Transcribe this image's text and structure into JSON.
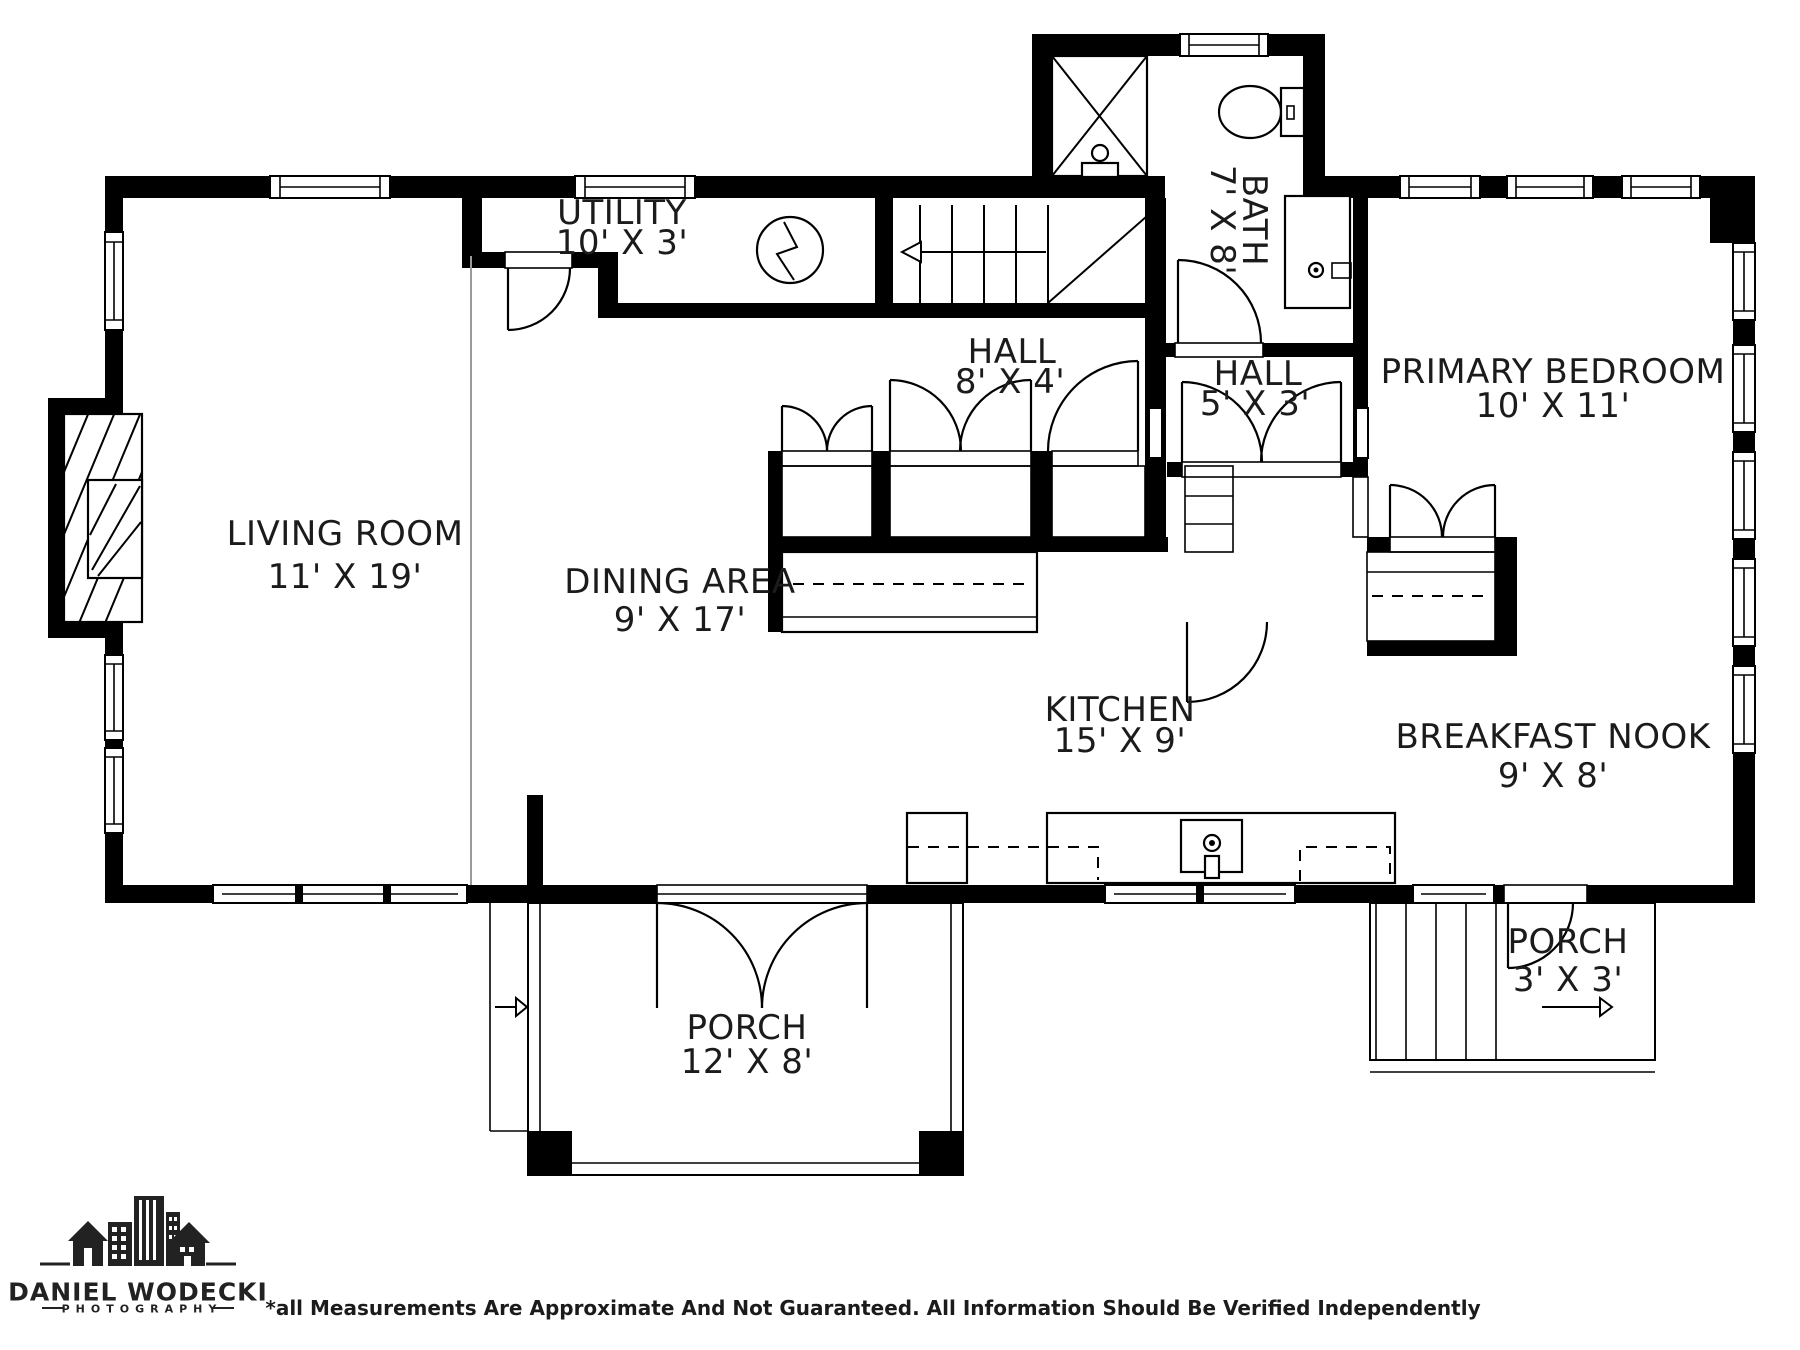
{
  "plan": {
    "rooms": [
      {
        "id": "living-room",
        "name": "LIVING ROOM",
        "dims": "11' X 19'"
      },
      {
        "id": "dining-area",
        "name": "DINING AREA",
        "dims": "9' X 17'"
      },
      {
        "id": "utility",
        "name": "UTILITY",
        "dims": "10' X 3'"
      },
      {
        "id": "hall-main",
        "name": "HALL",
        "dims": "8' X 4'"
      },
      {
        "id": "hall-small",
        "name": "HALL",
        "dims": "5' X 3'"
      },
      {
        "id": "bath",
        "name": "BATH",
        "dims": "7' X 8'"
      },
      {
        "id": "primary-bedroom",
        "name": "PRIMARY BEDROOM",
        "dims": "10' X 11'"
      },
      {
        "id": "kitchen",
        "name": "KITCHEN",
        "dims": "15' X 9'"
      },
      {
        "id": "breakfast-nook",
        "name": "BREAKFAST NOOK",
        "dims": "9' X 8'"
      },
      {
        "id": "porch-main",
        "name": "PORCH",
        "dims": "12' X 8'"
      },
      {
        "id": "porch-side",
        "name": "PORCH",
        "dims": "3' X 3'"
      }
    ],
    "fixtures": [
      "shower-icon",
      "toilet-icon",
      "bath-sink-icon",
      "kitchen-sink-icon",
      "dishwasher-icon",
      "fireplace-icon",
      "stairs-icon",
      "electrical-panel-icon"
    ]
  },
  "branding": {
    "studio_name": "DANIEL WODECKI",
    "studio_tagline": "PHOTOGRAPHY"
  },
  "footer": {
    "disclaimer": "*all Measurements Are Approximate And Not Guaranteed. All Information Should Be Verified Independently"
  },
  "colors": {
    "wall": "#000000",
    "background": "#ffffff",
    "text": "#1b1b1b"
  }
}
